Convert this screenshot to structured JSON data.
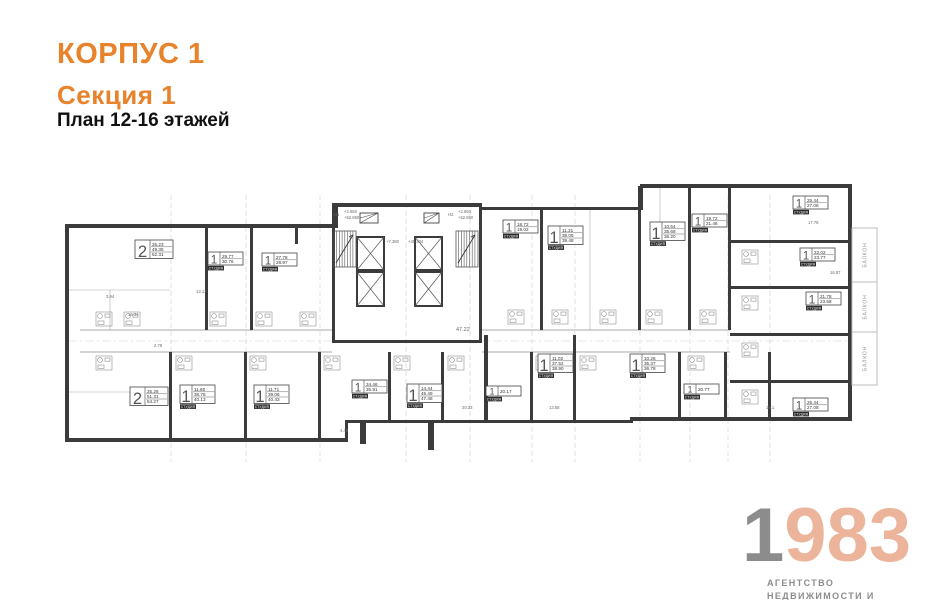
{
  "header": {
    "building": "КОРПУС 1",
    "section": "Секция 1",
    "caption": "План 12-16 этажей",
    "accent_color": "#E8832C"
  },
  "logo": {
    "year_gray": "1",
    "year_accent": "983",
    "line1": "АГЕНТСТВО",
    "line2": "НЕДВИЖИМОСТИ И ИНВЕСТИЦИЙ",
    "gray_color": "#8C8C8C",
    "accent_color": "#EBB49B",
    "sub_color": "#8d8d8d"
  },
  "plan": {
    "studio_tag": "СТУДИЯ",
    "balcony_label": "БАЛКОН",
    "units": [
      {
        "rooms": "2",
        "areas": [
          "25.23",
          "49.35",
          "52.31"
        ],
        "x": 135,
        "y": 240
      },
      {
        "rooms": "1",
        "areas": [
          "29.77",
          "30.76"
        ],
        "tag": true,
        "x": 208,
        "y": 252
      },
      {
        "rooms": "1",
        "areas": [
          "27.78",
          "28.97"
        ],
        "tag": true,
        "x": 262,
        "y": 253
      },
      {
        "rooms": "1",
        "areas": [
          "18.72",
          "19.02"
        ],
        "tag": true,
        "x": 503,
        "y": 220
      },
      {
        "rooms": "1",
        "areas": [
          "11.31",
          "38.05",
          "39.48"
        ],
        "tag": true,
        "x": 548,
        "y": 226
      },
      {
        "rooms": "1",
        "areas": [
          "10.54",
          "35.68",
          "36.20"
        ],
        "tag": true,
        "x": 650,
        "y": 222
      },
      {
        "rooms": "1",
        "areas": [
          "19.72",
          "21.46"
        ],
        "tag": true,
        "x": 692,
        "y": 214
      },
      {
        "rooms": "1",
        "areas": [
          "25.44",
          "27.08"
        ],
        "tag": true,
        "x": 793,
        "y": 196
      },
      {
        "rooms": "1",
        "areas": [
          "22.02",
          "23.77"
        ],
        "tag": true,
        "x": 800,
        "y": 248
      },
      {
        "rooms": "1",
        "areas": [
          "21.78",
          "23.58"
        ],
        "tag": true,
        "x": 806,
        "y": 292
      },
      {
        "rooms": "2",
        "areas": [
          "25.26",
          "51.31",
          "54.27"
        ],
        "x": 130,
        "y": 387
      },
      {
        "rooms": "1",
        "areas": [
          "11.60",
          "38.75",
          "40.13"
        ],
        "tag": true,
        "x": 180,
        "y": 385
      },
      {
        "rooms": "1",
        "areas": [
          "11.71",
          "39.06",
          "40.43"
        ],
        "tag": true,
        "x": 254,
        "y": 385
      },
      {
        "rooms": "1",
        "areas": [
          "34.46",
          "35.91"
        ],
        "tag": true,
        "x": 352,
        "y": 380
      },
      {
        "rooms": "1",
        "areas": [
          "14.44",
          "45.49",
          "47.48"
        ],
        "tag": true,
        "x": 407,
        "y": 384
      },
      {
        "rooms": "1",
        "areas": [
          "20.17"
        ],
        "tag": true,
        "x": 486,
        "y": 386
      },
      {
        "rooms": "1",
        "areas": [
          "11.02",
          "37.52",
          "38.90"
        ],
        "tag": true,
        "x": 538,
        "y": 354
      },
      {
        "rooms": "1",
        "areas": [
          "10.26",
          "35.37",
          "36.78"
        ],
        "tag": true,
        "x": 630,
        "y": 354
      },
      {
        "rooms": "1",
        "areas": [
          "20.77"
        ],
        "tag": true,
        "x": 684,
        "y": 384
      },
      {
        "rooms": "1",
        "areas": [
          "25.44",
          "27.08"
        ],
        "tag": true,
        "x": 793,
        "y": 398
      }
    ],
    "balconies": [
      {
        "x": 852,
        "y": 228,
        "w": 25,
        "h": 54
      },
      {
        "x": 852,
        "y": 282,
        "w": 25,
        "h": 50
      },
      {
        "x": 852,
        "y": 332,
        "w": 25,
        "h": 53
      }
    ],
    "annotations": [
      {
        "t": "+2.650",
        "x": 344,
        "y": 213
      },
      {
        "t": "+52.850",
        "x": 344,
        "y": 219
      },
      {
        "t": "Н1",
        "x": 334,
        "y": 216
      },
      {
        "t": "+2.650",
        "x": 458,
        "y": 213
      },
      {
        "t": "+52.850",
        "x": 458,
        "y": 219
      },
      {
        "t": "Н2",
        "x": 448,
        "y": 216
      },
      {
        "t": "+7.380",
        "x": 386,
        "y": 243
      },
      {
        "t": "+49.334",
        "x": 408,
        "y": 243
      },
      {
        "t": "47.22",
        "x": 456,
        "y": 331,
        "s": 5.5
      },
      {
        "t": "13.13",
        "x": 196,
        "y": 293
      },
      {
        "t": "3.94",
        "x": 106,
        "y": 298
      },
      {
        "t": "15.34",
        "x": 128,
        "y": 316
      },
      {
        "t": "2.78",
        "x": 154,
        "y": 347
      },
      {
        "t": "17.78",
        "x": 808,
        "y": 224
      },
      {
        "t": "16.87",
        "x": 830,
        "y": 274
      },
      {
        "t": "20.33",
        "x": 462,
        "y": 409
      },
      {
        "t": "13.58",
        "x": 549,
        "y": 409
      },
      {
        "t": "4.45",
        "x": 340,
        "y": 432
      },
      {
        "t": "18.1",
        "x": 766,
        "y": 409
      }
    ]
  }
}
